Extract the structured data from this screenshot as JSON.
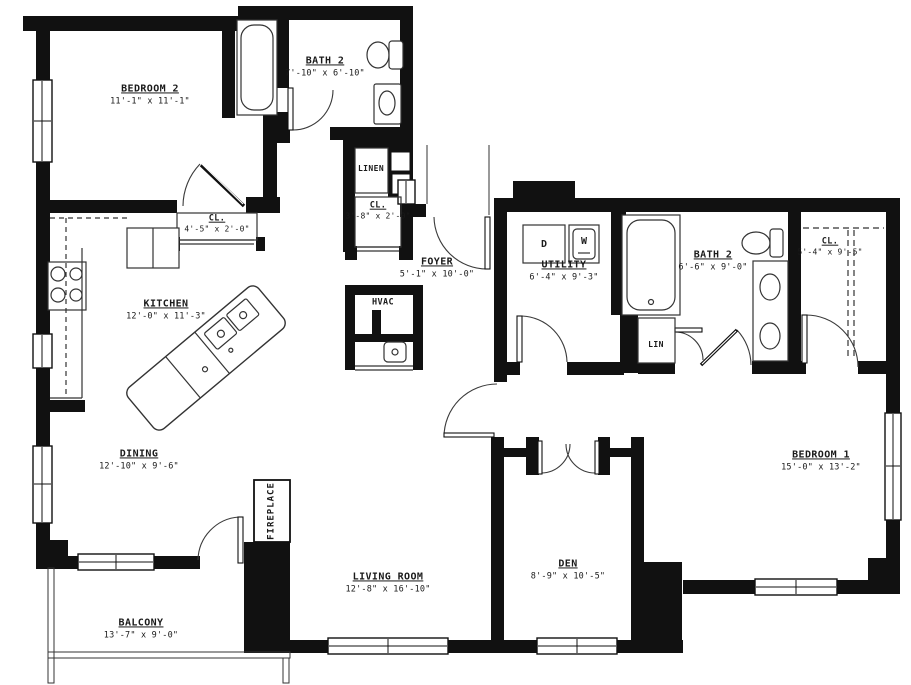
{
  "rooms": {
    "bedroom2": {
      "name": "BEDROOM 2",
      "dims": "11'-1\" x 11'-1\""
    },
    "bath2_upper": {
      "name": "BATH 2",
      "dims": "7'-10\" x 6'-10\""
    },
    "linen": {
      "name": "LINEN"
    },
    "closet_bedroom2": {
      "name": "CL.",
      "dims": "4'-5\" x 2'-0\""
    },
    "closet_hall": {
      "name": "CL.",
      "dims": "3'-8\" x 2'-0\""
    },
    "foyer": {
      "name": "FOYER",
      "dims": "5'-1\" x 10'-0\""
    },
    "hvac": {
      "name": "HVAC"
    },
    "kitchen": {
      "name": "KITCHEN",
      "dims": "12'-0\" x 11'-3\""
    },
    "utility": {
      "name": "UTILITY",
      "dims": "6'-4\" x 9'-3\""
    },
    "bath2_right": {
      "name": "BATH 2",
      "dims": "6'-6\" x 9'-0\""
    },
    "lin_closet": {
      "name": "LIN"
    },
    "closet_bedroom1": {
      "name": "CL.",
      "dims": "5'-4\" x 9'-5\""
    },
    "dining": {
      "name": "DINING",
      "dims": "12'-10\" x 9'-6\""
    },
    "fireplace": {
      "name": "FIREPLACE"
    },
    "living_room": {
      "name": "LIVING ROOM",
      "dims": "12'-8\" x 16'-10\""
    },
    "den": {
      "name": "DEN",
      "dims": "8'-9\" x 10'-5\""
    },
    "balcony": {
      "name": "BALCONY",
      "dims": "13'-7\" x 9'-0\""
    },
    "bedroom1": {
      "name": "BEDROOM 1",
      "dims": "15'-0\" x 13'-2\""
    }
  },
  "appliances": {
    "dryer_label": "D",
    "washer_label": "W"
  },
  "colors": {
    "wall": "#111111",
    "line": "#333333",
    "background": "#ffffff"
  }
}
